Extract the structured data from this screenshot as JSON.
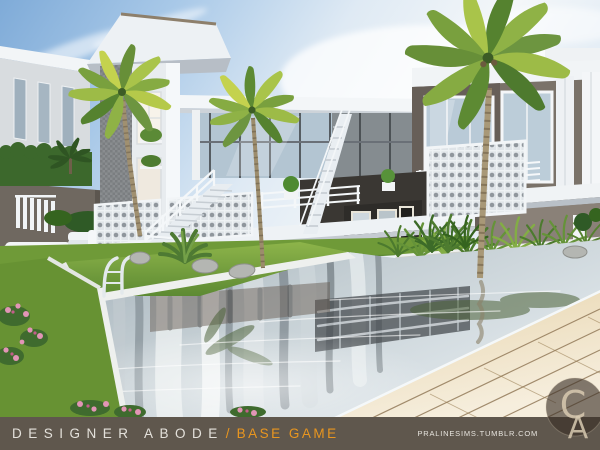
{
  "canvas": {
    "width": 600,
    "height": 450
  },
  "footer": {
    "title": "DESIGNER ABODE",
    "separator": "/",
    "subtitle": "BASE GAME",
    "url": "PRALINESIMS.TUMBLR.COM",
    "bar_color": "#5f574d",
    "title_color": "#e4e1db",
    "accent_color": "#e9961f",
    "url_color": "#e7e4de"
  },
  "watermark": {
    "letter_c": "C",
    "letter_a": "A",
    "circle_color": "rgba(56,45,37,0.62)",
    "letter_color": "#d8cab1"
  },
  "scene": {
    "elements": [
      "sky",
      "cloud-streaks",
      "modern-two-story-house",
      "glass-walls",
      "white-balcony-railings",
      "lattice-panels",
      "staircases",
      "palm-trees",
      "rooftop-hedge",
      "swimming-pool",
      "water-reflections",
      "lawn-islands",
      "agave-plant",
      "rocks",
      "tall-grasses",
      "white-outdoor-sofa",
      "white-armchair",
      "pool-handrail-ladder",
      "pink-flowers",
      "tiled-deck"
    ],
    "palette": {
      "sky_blue": "#7fabd8",
      "sky_haze": "#f3f6f8",
      "wall_white": "#f2f5f7",
      "wall_taupe": "#6b645c",
      "wall_gray": "#8e9497",
      "glass": "#b5c7d4",
      "frame_dark": "#3f4347",
      "hedge_green": "#3c682c",
      "lawn_green": "#7fae3f",
      "palm_green": "#6d9440",
      "palm_yellow": "#c4d24e",
      "trunk_brown": "#a09070",
      "water_steel": "#9fadb6",
      "water_light": "#e3eaee",
      "reflection_dark": "#59646b",
      "deck_tan": "#eedfbc",
      "grout_brown": "#8d7352",
      "coping_white": "#eef0ee",
      "stone_gray": "#cfcfc9",
      "flower_pink": "#e295b6",
      "chrome": "#e3e9ec"
    }
  }
}
